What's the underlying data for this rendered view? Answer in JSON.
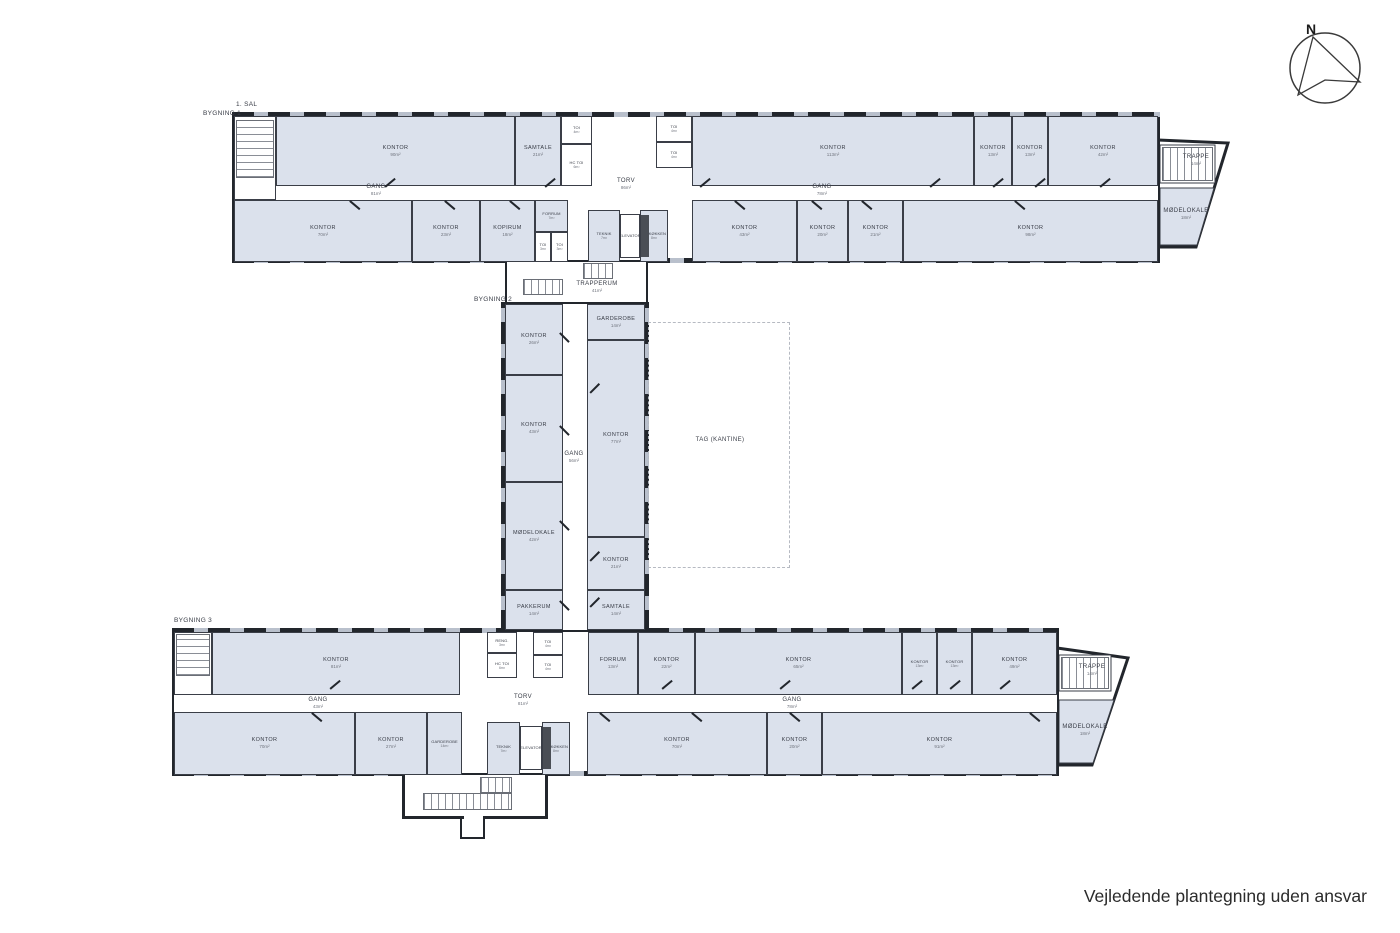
{
  "footer": {
    "note": "Vejledende plantegning uden ansvar"
  },
  "compass": {
    "label": "N"
  },
  "colors": {
    "wall": "#22262c",
    "room_fill": "#dbe1ec",
    "window_gap": "#b9c0cc",
    "label_text": "#383c46"
  },
  "plan": {
    "plan_labels": [
      {
        "id": "floor-label",
        "text": "1. SAL",
        "x": 236,
        "y": 101
      },
      {
        "id": "building-1-label",
        "text": "BYGNING 1",
        "x": 203,
        "y": 110
      },
      {
        "id": "building-2-label",
        "text": "BYGNING 2",
        "x": 474,
        "y": 296
      },
      {
        "id": "building-3-label",
        "text": "BYGNING 3",
        "x": 174,
        "y": 617
      }
    ],
    "shells": [
      {
        "id": "building-1-outline",
        "x": 232,
        "y": 114,
        "w": 928,
        "h": 148
      },
      {
        "id": "building-2-outline",
        "x": 503,
        "y": 302,
        "w": 144,
        "h": 330
      },
      {
        "id": "building-3-outline",
        "x": 172,
        "y": 630,
        "w": 887,
        "h": 145
      }
    ],
    "window_walls": [
      {
        "x": 232,
        "y": 112,
        "w": 928,
        "h": 5,
        "dir": "h"
      },
      {
        "x": 232,
        "y": 258,
        "w": 273,
        "h": 5,
        "dir": "h"
      },
      {
        "x": 648,
        "y": 258,
        "w": 512,
        "h": 5,
        "dir": "h"
      },
      {
        "x": 501,
        "y": 302,
        "w": 5,
        "h": 330,
        "dir": "v"
      },
      {
        "x": 644,
        "y": 302,
        "w": 5,
        "h": 330,
        "dir": "v"
      },
      {
        "x": 172,
        "y": 628,
        "w": 331,
        "h": 5,
        "dir": "h"
      },
      {
        "x": 647,
        "y": 628,
        "w": 412,
        "h": 5,
        "dir": "h"
      },
      {
        "x": 172,
        "y": 771,
        "w": 230,
        "h": 5,
        "dir": "h"
      },
      {
        "x": 548,
        "y": 771,
        "w": 511,
        "h": 5,
        "dir": "h"
      }
    ],
    "walls": [
      {
        "x": 505,
        "y": 260,
        "w": 2,
        "h": 44
      },
      {
        "x": 646,
        "y": 260,
        "w": 2,
        "h": 44
      },
      {
        "x": 402,
        "y": 775,
        "w": 3,
        "h": 44
      },
      {
        "x": 545,
        "y": 775,
        "w": 3,
        "h": 44
      },
      {
        "x": 402,
        "y": 816,
        "w": 62,
        "h": 3
      },
      {
        "x": 483,
        "y": 816,
        "w": 65,
        "h": 3
      },
      {
        "x": 460,
        "y": 816,
        "w": 2,
        "h": 23
      },
      {
        "x": 483,
        "y": 816,
        "w": 2,
        "h": 23
      },
      {
        "x": 460,
        "y": 837,
        "w": 25,
        "h": 2
      }
    ],
    "rooms": [
      {
        "id": "b1-stairwell-west",
        "label": "",
        "area": "",
        "x": 234,
        "y": 116,
        "w": 42,
        "h": 84,
        "t": "stair"
      },
      {
        "id": "b1-kontor-90",
        "label": "KONTOR",
        "area": "90m²",
        "x": 276,
        "y": 116,
        "w": 239,
        "h": 70,
        "t": "office"
      },
      {
        "id": "b1-samtale-21",
        "label": "SAMTALE",
        "area": "21m²",
        "x": 515,
        "y": 116,
        "w": 46,
        "h": 70,
        "t": "office"
      },
      {
        "id": "b1-toi-4-nw",
        "label": "TOI",
        "area": "4m²",
        "x": 561,
        "y": 116,
        "w": 31,
        "h": 28,
        "t": "service"
      },
      {
        "id": "b1-hc-toi-6",
        "label": "HC TOI",
        "area": "6m²",
        "x": 561,
        "y": 144,
        "w": 31,
        "h": 42,
        "t": "service"
      },
      {
        "id": "b1-toi-4-ne1",
        "label": "TOI",
        "area": "4m²",
        "x": 656,
        "y": 116,
        "w": 36,
        "h": 26,
        "t": "service"
      },
      {
        "id": "b1-toi-4-ne2",
        "label": "TOI",
        "area": "4m²",
        "x": 656,
        "y": 142,
        "w": 36,
        "h": 26,
        "t": "service"
      },
      {
        "id": "b1-kontor-113",
        "label": "KONTOR",
        "area": "113m²",
        "x": 692,
        "y": 116,
        "w": 282,
        "h": 70,
        "t": "office"
      },
      {
        "id": "b1-kontor-13-a",
        "label": "KONTOR",
        "area": "13m²",
        "x": 974,
        "y": 116,
        "w": 38,
        "h": 70,
        "t": "office"
      },
      {
        "id": "b1-kontor-13-b",
        "label": "KONTOR",
        "area": "13m²",
        "x": 1012,
        "y": 116,
        "w": 36,
        "h": 70,
        "t": "office"
      },
      {
        "id": "b1-kontor-42",
        "label": "KONTOR",
        "area": "42m²",
        "x": 1048,
        "y": 116,
        "w": 110,
        "h": 70,
        "t": "office"
      },
      {
        "id": "b1-kontor-70",
        "label": "KONTOR",
        "area": "70m²",
        "x": 234,
        "y": 200,
        "w": 178,
        "h": 62,
        "t": "office"
      },
      {
        "id": "b1-kontor-23",
        "label": "KONTOR",
        "area": "23m²",
        "x": 412,
        "y": 200,
        "w": 68,
        "h": 62,
        "t": "office"
      },
      {
        "id": "b1-kopirum-18",
        "label": "KOPIRUM",
        "area": "18m²",
        "x": 480,
        "y": 200,
        "w": 55,
        "h": 62,
        "t": "office"
      },
      {
        "id": "b1-forrum-7",
        "label": "FORRUM",
        "area": "7m²",
        "x": 535,
        "y": 200,
        "w": 33,
        "h": 32,
        "t": "office"
      },
      {
        "id": "b1-toi-3-a",
        "label": "TOI",
        "area": "3m²",
        "x": 535,
        "y": 232,
        "w": 16,
        "h": 30,
        "t": "service"
      },
      {
        "id": "b1-toi-3-b",
        "label": "TOI",
        "area": "3m²",
        "x": 551,
        "y": 232,
        "w": 17,
        "h": 30,
        "t": "service"
      },
      {
        "id": "b1-teknik-7",
        "label": "TEKNIK",
        "area": "7m²",
        "x": 588,
        "y": 210,
        "w": 32,
        "h": 52,
        "t": "office"
      },
      {
        "id": "b1-elevator",
        "label": "ELEVATOR",
        "area": "",
        "x": 620,
        "y": 214,
        "w": 20,
        "h": 44,
        "t": "service"
      },
      {
        "id": "b1-tekokken-8",
        "label": "TE-KØKKEN",
        "area": "8m²",
        "x": 640,
        "y": 210,
        "w": 28,
        "h": 52,
        "t": "office"
      },
      {
        "id": "b1-kontor-43",
        "label": "KONTOR",
        "area": "43m²",
        "x": 692,
        "y": 200,
        "w": 105,
        "h": 62,
        "t": "office"
      },
      {
        "id": "b1-kontor-20",
        "label": "KONTOR",
        "area": "20m²",
        "x": 797,
        "y": 200,
        "w": 51,
        "h": 62,
        "t": "office"
      },
      {
        "id": "b1-kontor-21",
        "label": "KONTOR",
        "area": "21m²",
        "x": 848,
        "y": 200,
        "w": 55,
        "h": 62,
        "t": "office"
      },
      {
        "id": "b1-kontor-98",
        "label": "KONTOR",
        "area": "98m²",
        "x": 903,
        "y": 200,
        "w": 255,
        "h": 62,
        "t": "office"
      },
      {
        "id": "b2-kontor-26",
        "label": "KONTOR",
        "area": "26m²",
        "x": 505,
        "y": 304,
        "w": 58,
        "h": 71,
        "t": "office"
      },
      {
        "id": "b2-kontor-43",
        "label": "KONTOR",
        "area": "43m²",
        "x": 505,
        "y": 375,
        "w": 58,
        "h": 107,
        "t": "office"
      },
      {
        "id": "b2-moedelokale-42",
        "label": "MØDELOKALE",
        "area": "42m²",
        "x": 505,
        "y": 482,
        "w": 58,
        "h": 108,
        "t": "office"
      },
      {
        "id": "b2-pakkerum-14",
        "label": "PAKKERUM",
        "area": "14m²",
        "x": 505,
        "y": 590,
        "w": 58,
        "h": 40,
        "t": "office"
      },
      {
        "id": "b2-garderobe-14",
        "label": "GARDEROBE",
        "area": "14m²",
        "x": 587,
        "y": 304,
        "w": 58,
        "h": 36,
        "t": "office"
      },
      {
        "id": "b2-kontor-77",
        "label": "KONTOR",
        "area": "77m²",
        "x": 587,
        "y": 340,
        "w": 58,
        "h": 197,
        "t": "office"
      },
      {
        "id": "b2-kontor-21",
        "label": "KONTOR",
        "area": "21m²",
        "x": 587,
        "y": 537,
        "w": 58,
        "h": 53,
        "t": "office"
      },
      {
        "id": "b2-samtale-14",
        "label": "SAMTALE",
        "area": "14m²",
        "x": 587,
        "y": 590,
        "w": 58,
        "h": 40,
        "t": "office"
      },
      {
        "id": "b3-trappe-16",
        "label": "TRAPPE",
        "area": "16m²",
        "x": 174,
        "y": 632,
        "w": 38,
        "h": 63,
        "t": "stair"
      },
      {
        "id": "b3-kontor-81",
        "label": "KONTOR",
        "area": "81m²",
        "x": 212,
        "y": 632,
        "w": 248,
        "h": 63,
        "t": "office"
      },
      {
        "id": "b3-reng-3",
        "label": "RENG.",
        "area": "3m²",
        "x": 487,
        "y": 632,
        "w": 30,
        "h": 21,
        "t": "service"
      },
      {
        "id": "b3-hc-toi-6",
        "label": "HC TOI",
        "area": "6m²",
        "x": 487,
        "y": 653,
        "w": 30,
        "h": 25,
        "t": "service"
      },
      {
        "id": "b3-toi-4-a",
        "label": "TOI",
        "area": "4m²",
        "x": 533,
        "y": 632,
        "w": 30,
        "h": 23,
        "t": "service"
      },
      {
        "id": "b3-toi-4-b",
        "label": "TOI",
        "area": "4m²",
        "x": 533,
        "y": 655,
        "w": 30,
        "h": 23,
        "t": "service"
      },
      {
        "id": "b3-forrum-13",
        "label": "FORRUM",
        "area": "13m²",
        "x": 588,
        "y": 632,
        "w": 50,
        "h": 63,
        "t": "office"
      },
      {
        "id": "b3-kontor-22",
        "label": "KONTOR",
        "area": "22m²",
        "x": 638,
        "y": 632,
        "w": 57,
        "h": 63,
        "t": "office"
      },
      {
        "id": "b3-kontor-65",
        "label": "KONTOR",
        "area": "65m²",
        "x": 695,
        "y": 632,
        "w": 207,
        "h": 63,
        "t": "office"
      },
      {
        "id": "b3-kontor-13-a",
        "label": "KONTOR",
        "area": "13m²",
        "x": 902,
        "y": 632,
        "w": 35,
        "h": 63,
        "t": "office"
      },
      {
        "id": "b3-kontor-13-b",
        "label": "KONTOR",
        "area": "13m²",
        "x": 937,
        "y": 632,
        "w": 35,
        "h": 63,
        "t": "office"
      },
      {
        "id": "b3-kontor-49",
        "label": "KONTOR",
        "area": "49m²",
        "x": 972,
        "y": 632,
        "w": 85,
        "h": 63,
        "t": "office"
      },
      {
        "id": "b3-kontor-70-west",
        "label": "KONTOR",
        "area": "70m²",
        "x": 174,
        "y": 712,
        "w": 181,
        "h": 63,
        "t": "office"
      },
      {
        "id": "b3-kontor-27",
        "label": "KONTOR",
        "area": "27m²",
        "x": 355,
        "y": 712,
        "w": 72,
        "h": 63,
        "t": "office"
      },
      {
        "id": "b3-garderobe-14",
        "label": "GARDEROBE",
        "area": "14m²",
        "x": 427,
        "y": 712,
        "w": 35,
        "h": 63,
        "t": "office"
      },
      {
        "id": "b3-teknik-7",
        "label": "TEKNIK",
        "area": "7m²",
        "x": 487,
        "y": 722,
        "w": 33,
        "h": 53,
        "t": "office"
      },
      {
        "id": "b3-elevator",
        "label": "ELEVATOR",
        "area": "",
        "x": 520,
        "y": 726,
        "w": 22,
        "h": 44,
        "t": "service"
      },
      {
        "id": "b3-tekokken-8",
        "label": "TE-KØKKEN",
        "area": "8m²",
        "x": 542,
        "y": 722,
        "w": 28,
        "h": 53,
        "t": "office"
      },
      {
        "id": "b3-kontor-70-east",
        "label": "KONTOR",
        "area": "70m²",
        "x": 587,
        "y": 712,
        "w": 180,
        "h": 63,
        "t": "office"
      },
      {
        "id": "b3-kontor-20",
        "label": "KONTOR",
        "area": "20m²",
        "x": 767,
        "y": 712,
        "w": 55,
        "h": 63,
        "t": "office"
      },
      {
        "id": "b3-kontor-91",
        "label": "KONTOR",
        "area": "91m²",
        "x": 822,
        "y": 712,
        "w": 235,
        "h": 63,
        "t": "office"
      }
    ],
    "float_labels": [
      {
        "id": "b1-torv-86",
        "text": "TORV",
        "area": "86m²",
        "x": 626,
        "y": 184
      },
      {
        "id": "b1-gang-81",
        "text": "GANG",
        "area": "81m²",
        "x": 376,
        "y": 190
      },
      {
        "id": "b1-gang-78",
        "text": "GANG",
        "area": "78m²",
        "x": 822,
        "y": 190
      },
      {
        "id": "trapperum-41",
        "text": "TRAPPERUM",
        "area": "41m²",
        "x": 597,
        "y": 287
      },
      {
        "id": "b2-gang-56",
        "text": "GANG",
        "area": "56m²",
        "x": 574,
        "y": 457
      },
      {
        "id": "tag-kantine",
        "text": "TAG (KANTINE)",
        "area": "",
        "x": 720,
        "y": 440
      },
      {
        "id": "b3-torv-81",
        "text": "TORV",
        "area": "81m²",
        "x": 523,
        "y": 700
      },
      {
        "id": "b3-gang-43",
        "text": "GANG",
        "area": "43m²",
        "x": 318,
        "y": 703
      },
      {
        "id": "b3-gang-78",
        "text": "GANG",
        "area": "78m²",
        "x": 792,
        "y": 703
      },
      {
        "id": "b1-trappe-14-east",
        "text": "TRAPPE",
        "area": "14m²",
        "x": 1196,
        "y": 160
      },
      {
        "id": "b1-moedelokale-18-east",
        "text": "MØDELOKALE",
        "area": "18m²",
        "x": 1186,
        "y": 214
      },
      {
        "id": "b3-trappe-14-east",
        "text": "TRAPPE",
        "area": "14m²",
        "x": 1092,
        "y": 670
      },
      {
        "id": "b3-moedelokale-18-east",
        "text": "MØDELOKALE",
        "area": "18m²",
        "x": 1085,
        "y": 730
      }
    ],
    "dashed_areas": [
      {
        "id": "tag-kantine-area",
        "x": 648,
        "y": 322,
        "w": 142,
        "h": 246
      }
    ],
    "stairs": [
      {
        "x": 236,
        "y": 120,
        "w": 38,
        "h": 58,
        "dir": "v"
      },
      {
        "x": 1162,
        "y": 147,
        "w": 51,
        "h": 34,
        "dir": "h"
      },
      {
        "x": 583,
        "y": 263,
        "w": 30,
        "h": 16,
        "dir": "h"
      },
      {
        "x": 523,
        "y": 279,
        "w": 40,
        "h": 16,
        "dir": "h"
      },
      {
        "x": 176,
        "y": 634,
        "w": 34,
        "h": 42,
        "dir": "v"
      },
      {
        "x": 1061,
        "y": 657,
        "w": 48,
        "h": 32,
        "dir": "h"
      },
      {
        "x": 480,
        "y": 777,
        "w": 32,
        "h": 16,
        "dir": "h"
      },
      {
        "x": 423,
        "y": 793,
        "w": 89,
        "h": 17,
        "dir": "h"
      }
    ],
    "extras": [
      {
        "x": 641,
        "y": 215,
        "w": 8,
        "h": 42,
        "c": "#4a4e55"
      },
      {
        "x": 543,
        "y": 727,
        "w": 8,
        "h": 42,
        "c": "#4a4e55"
      }
    ],
    "doors": [
      [
        385,
        186,
        -40
      ],
      [
        545,
        186,
        -40
      ],
      [
        700,
        186,
        -40
      ],
      [
        930,
        186,
        -40
      ],
      [
        993,
        186,
        -40
      ],
      [
        1035,
        186,
        -40
      ],
      [
        1100,
        186,
        -40
      ],
      [
        350,
        200,
        40
      ],
      [
        445,
        200,
        40
      ],
      [
        510,
        200,
        40
      ],
      [
        735,
        200,
        40
      ],
      [
        812,
        200,
        40
      ],
      [
        862,
        200,
        40
      ],
      [
        1015,
        200,
        40
      ],
      [
        560,
        332,
        45
      ],
      [
        560,
        425,
        45
      ],
      [
        560,
        520,
        45
      ],
      [
        560,
        600,
        45
      ],
      [
        590,
        392,
        -45
      ],
      [
        590,
        560,
        -45
      ],
      [
        590,
        606,
        -45
      ],
      [
        330,
        688,
        -40
      ],
      [
        662,
        688,
        -40
      ],
      [
        780,
        688,
        -40
      ],
      [
        912,
        688,
        -40
      ],
      [
        950,
        688,
        -40
      ],
      [
        1000,
        688,
        -40
      ],
      [
        312,
        712,
        40
      ],
      [
        600,
        712,
        40
      ],
      [
        692,
        712,
        40
      ],
      [
        790,
        712,
        40
      ],
      [
        1030,
        712,
        40
      ]
    ]
  }
}
